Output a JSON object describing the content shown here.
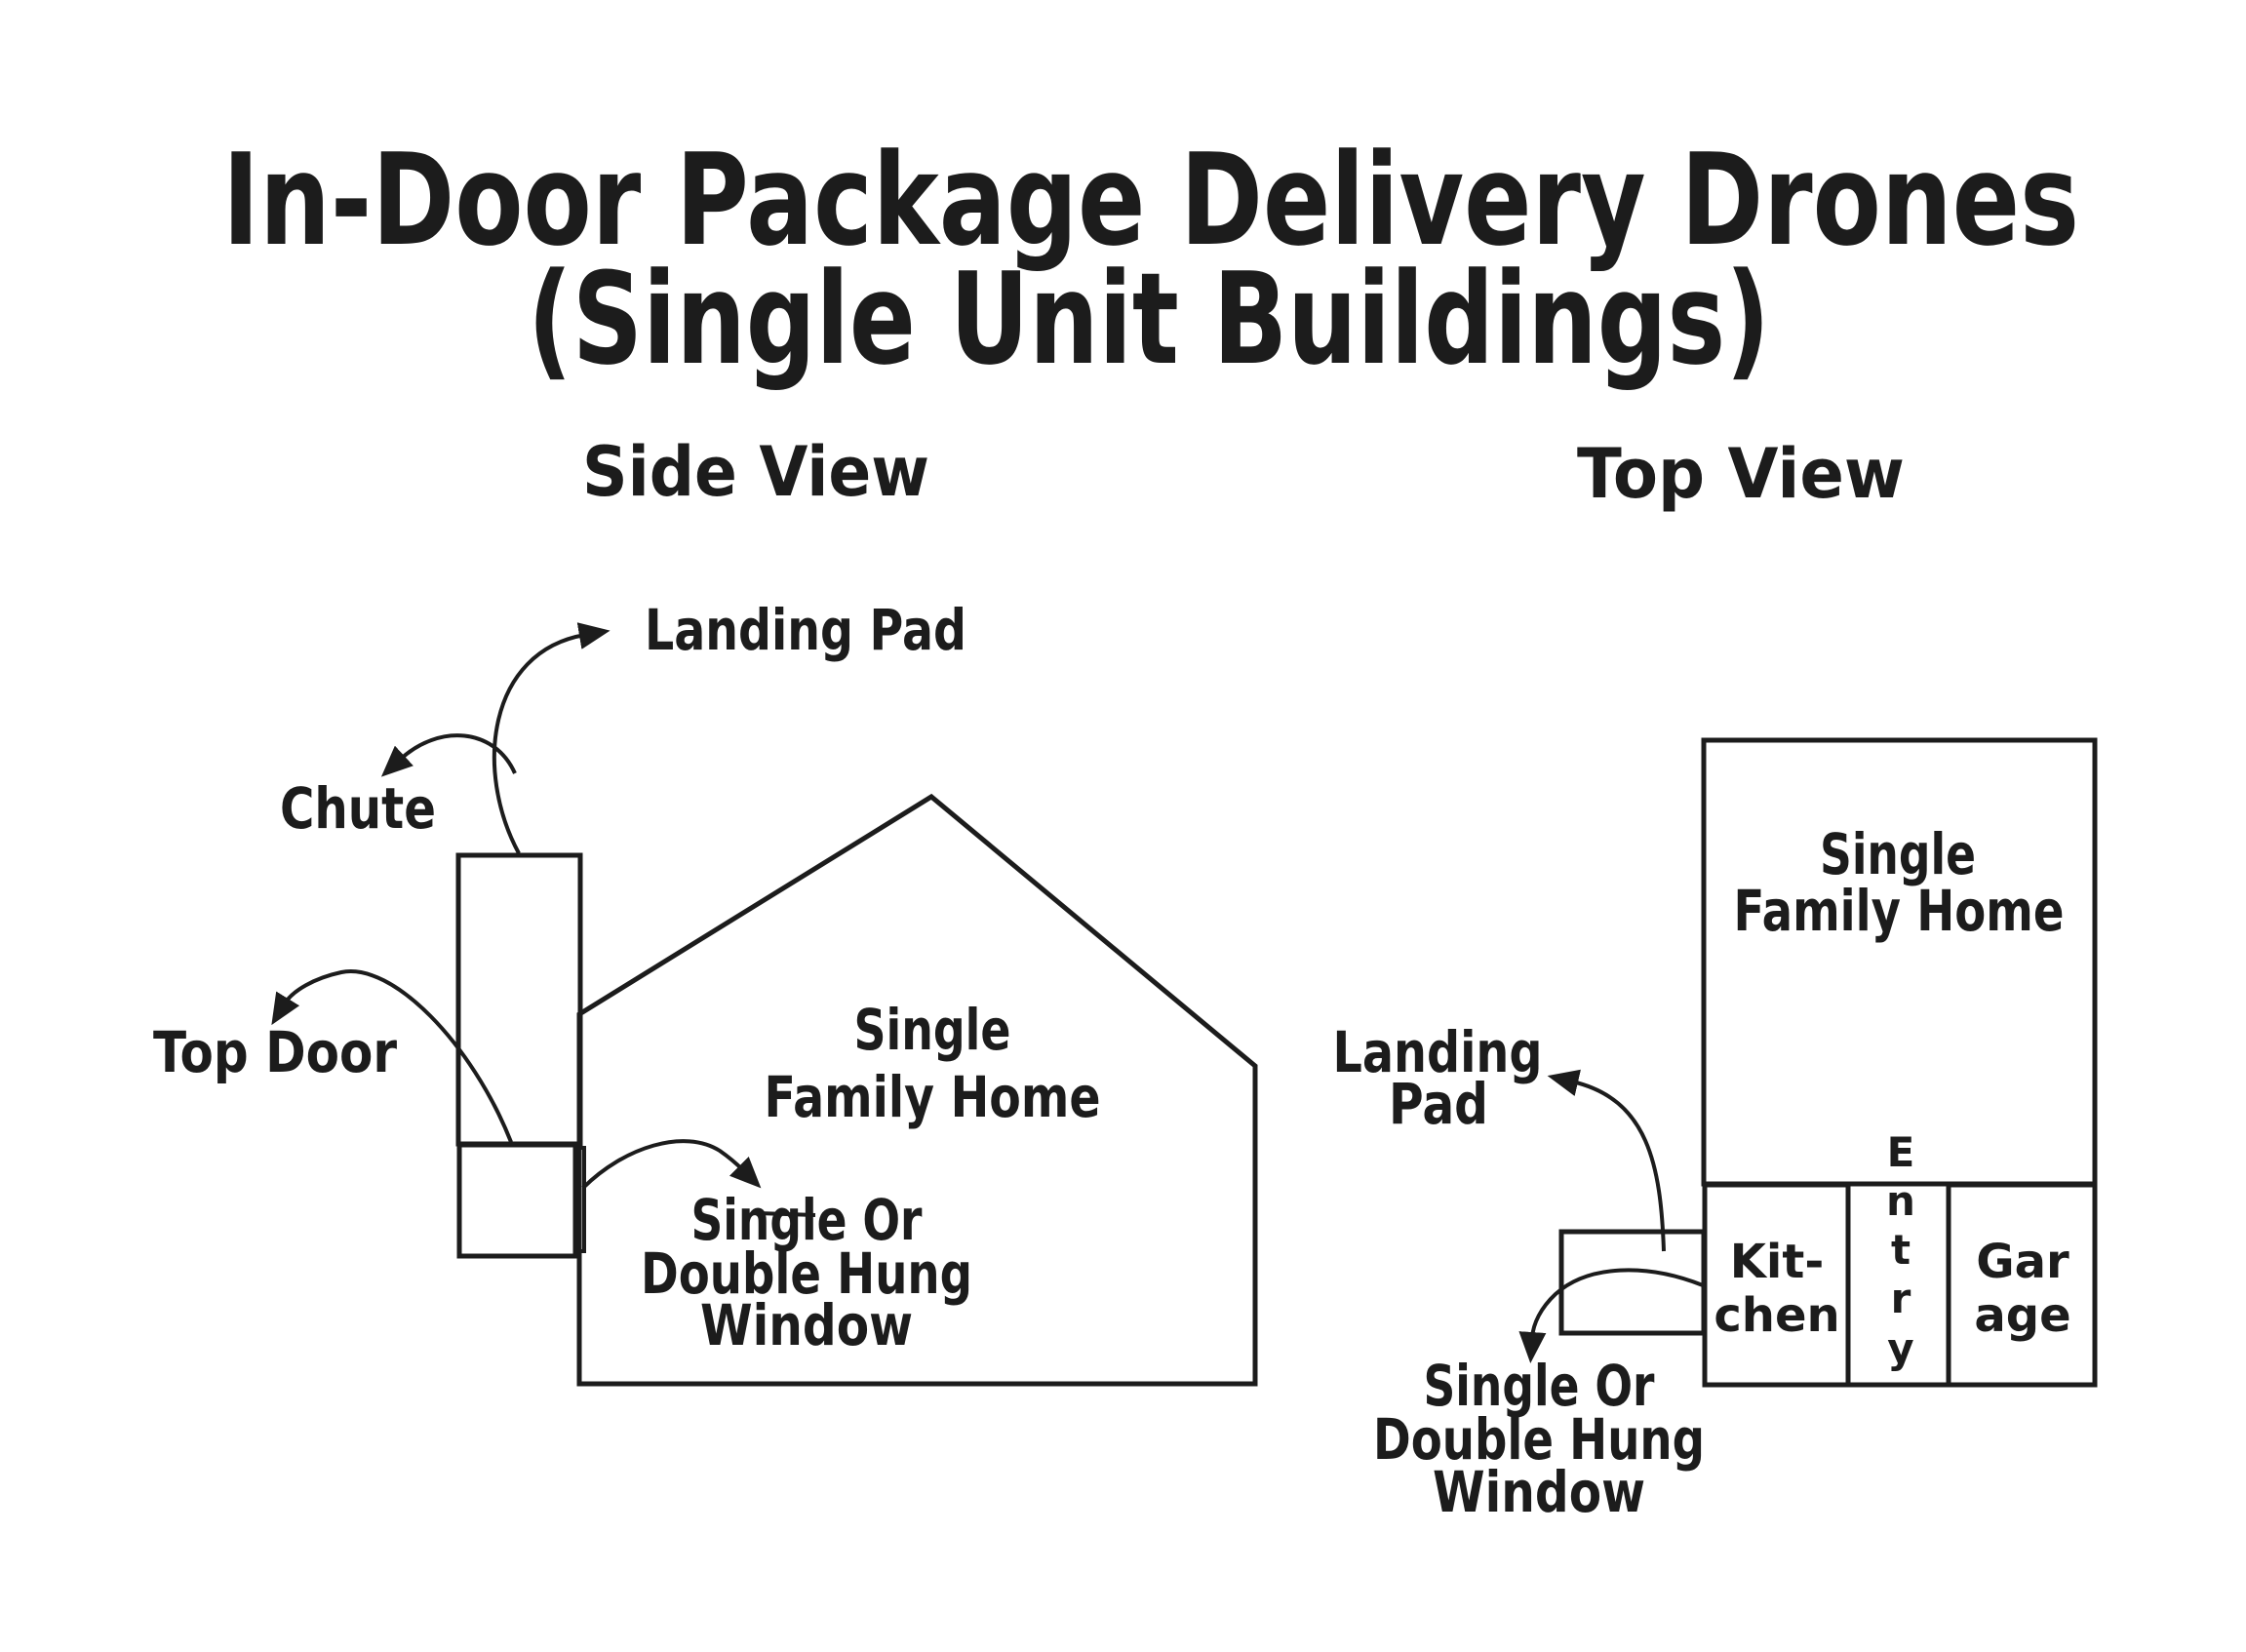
{
  "title": {
    "line1": "In-Door Package Delivery Drones",
    "line2": "(Single Unit Buildings)"
  },
  "side_view": {
    "heading": "Side View",
    "labels": {
      "landing_pad": "Landing Pad",
      "chute": "Chute",
      "top_door": "Top Door",
      "home": [
        "Single",
        "Family Home"
      ],
      "window": [
        "Single Or",
        "Double Hung",
        "Window"
      ]
    }
  },
  "top_view": {
    "heading": "Top View",
    "labels": {
      "home": [
        "Single",
        "Family Home"
      ],
      "landing_pad": [
        "Landing",
        "Pad"
      ],
      "kitchen": [
        "Kit-",
        "chen"
      ],
      "garage": [
        "Gar",
        "age"
      ],
      "entry": [
        "E",
        "n",
        "t",
        "r",
        "y"
      ],
      "window": [
        "Single Or",
        "Double Hung",
        "Window"
      ]
    }
  },
  "colors": {
    "ink": "#1c1c1c",
    "background": "#ffffff"
  }
}
